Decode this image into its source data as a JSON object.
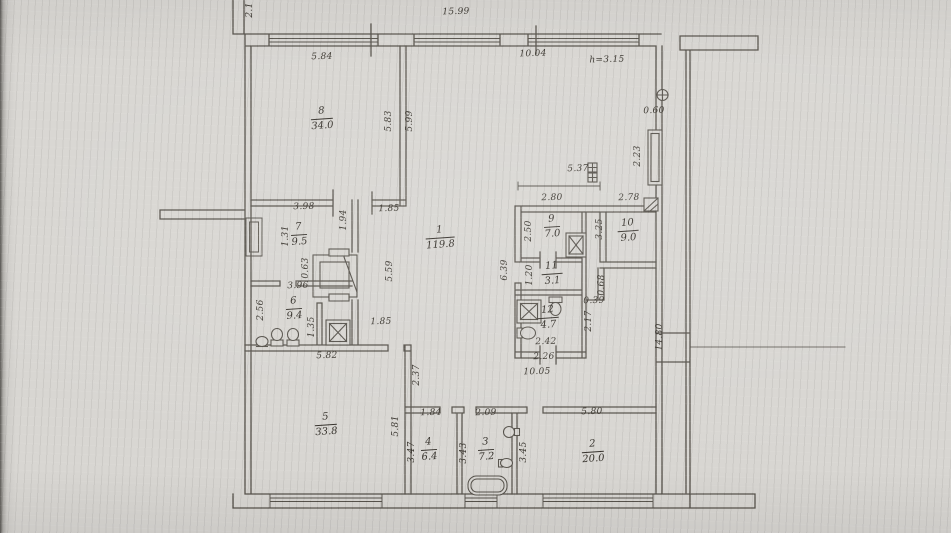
{
  "meta": {
    "type": "scanned-floor-plan",
    "paper_color": "#d8d6d2",
    "ink_color": "#55514a",
    "text_color": "#39352e"
  },
  "icons": {
    "shaft-square-x": "square with X diagonals (duct/lift shaft)",
    "vent-square-diagonal": "square with diagonal hatch (flue)",
    "meter-boxes": "two small gridded squares (meters)",
    "wall-socket-circle": "circle with bar on wall",
    "toilet": "bowl ellipse with tank rectangle",
    "sink": "oval basin",
    "bathtub": "rounded rectangle tub",
    "shower-tray": "double square with X",
    "entrance-vestibule": "nested rectangles with diagonal"
  },
  "plan": {
    "ceiling_note": "h=3.15",
    "rooms": [
      {
        "n": "8",
        "a": "34.0",
        "x": 322,
        "y": 119
      },
      {
        "n": "1",
        "a": "119.8",
        "x": 440,
        "y": 238
      },
      {
        "n": "7",
        "a": "9.5",
        "x": 299,
        "y": 235
      },
      {
        "n": "6",
        "a": "9.4",
        "x": 294,
        "y": 309
      },
      {
        "n": "9",
        "a": "7.0",
        "x": 552,
        "y": 227
      },
      {
        "n": "10",
        "a": "9.0",
        "x": 628,
        "y": 231
      },
      {
        "n": "11",
        "a": "3.1",
        "x": 552,
        "y": 274
      },
      {
        "n": "12",
        "a": "4.7",
        "x": 548,
        "y": 318
      },
      {
        "n": "5",
        "a": "33.8",
        "x": 326,
        "y": 425
      },
      {
        "n": "4",
        "a": "6.4",
        "x": 429,
        "y": 450
      },
      {
        "n": "3",
        "a": "7.2",
        "x": 486,
        "y": 450
      },
      {
        "n": "2",
        "a": "20.0",
        "x": 593,
        "y": 452
      }
    ],
    "dims": [
      {
        "t": "15.99",
        "x": 456,
        "y": 12,
        "rot": 0
      },
      {
        "t": "2.1",
        "x": 250,
        "y": 10,
        "rot": 1
      },
      {
        "t": "5.84",
        "x": 322,
        "y": 57,
        "rot": 0
      },
      {
        "t": "10.04",
        "x": 533,
        "y": 54,
        "rot": 0
      },
      {
        "t": "h=3.15",
        "x": 607,
        "y": 60,
        "rot": 0
      },
      {
        "t": "0.60",
        "x": 654,
        "y": 111,
        "rot": 0
      },
      {
        "t": "5.83",
        "x": 389,
        "y": 121,
        "rot": 1
      },
      {
        "t": "5.99",
        "x": 410,
        "y": 121,
        "rot": 1
      },
      {
        "t": "2.23",
        "x": 638,
        "y": 156,
        "rot": 1
      },
      {
        "t": "5.37",
        "x": 578,
        "y": 169,
        "rot": 0
      },
      {
        "t": "2.80",
        "x": 552,
        "y": 198,
        "rot": 0
      },
      {
        "t": "2.78",
        "x": 629,
        "y": 198,
        "rot": 0
      },
      {
        "t": "3.98",
        "x": 304,
        "y": 207,
        "rot": 0
      },
      {
        "t": "1.85",
        "x": 389,
        "y": 209,
        "rot": 0
      },
      {
        "t": "1.94",
        "x": 344,
        "y": 220,
        "rot": 1
      },
      {
        "t": "1.31",
        "x": 286,
        "y": 236,
        "rot": 1
      },
      {
        "t": "2.50",
        "x": 529,
        "y": 231,
        "rot": 1
      },
      {
        "t": "3.25",
        "x": 600,
        "y": 229,
        "rot": 1
      },
      {
        "t": "0.63",
        "x": 306,
        "y": 268,
        "rot": 1
      },
      {
        "t": "5.59",
        "x": 390,
        "y": 271,
        "rot": 1
      },
      {
        "t": "6.39",
        "x": 505,
        "y": 270,
        "rot": 1
      },
      {
        "t": "1.20",
        "x": 530,
        "y": 275,
        "rot": 1
      },
      {
        "t": "0.68",
        "x": 602,
        "y": 285,
        "rot": 1
      },
      {
        "t": "3.96",
        "x": 298,
        "y": 286,
        "rot": 0
      },
      {
        "t": "0.39",
        "x": 594,
        "y": 301,
        "rot": 0
      },
      {
        "t": "2.56",
        "x": 261,
        "y": 310,
        "rot": 1
      },
      {
        "t": "1.35",
        "x": 312,
        "y": 327,
        "rot": 1
      },
      {
        "t": "2.17",
        "x": 589,
        "y": 321,
        "rot": 1
      },
      {
        "t": "1.85",
        "x": 381,
        "y": 322,
        "rot": 0
      },
      {
        "t": "14.80",
        "x": 660,
        "y": 337,
        "rot": 1
      },
      {
        "t": "2.42",
        "x": 546,
        "y": 342,
        "rot": 0
      },
      {
        "t": "5.82",
        "x": 327,
        "y": 356,
        "rot": 0
      },
      {
        "t": "2.26",
        "x": 544,
        "y": 357,
        "rot": 0
      },
      {
        "t": "10.05",
        "x": 537,
        "y": 372,
        "rot": 0
      },
      {
        "t": "2.37",
        "x": 417,
        "y": 375,
        "rot": 1
      },
      {
        "t": "1.84",
        "x": 431,
        "y": 413,
        "rot": 0
      },
      {
        "t": "2.09",
        "x": 486,
        "y": 413,
        "rot": 0
      },
      {
        "t": "5.80",
        "x": 592,
        "y": 412,
        "rot": 0
      },
      {
        "t": "5.81",
        "x": 396,
        "y": 426,
        "rot": 1
      },
      {
        "t": "3.47",
        "x": 412,
        "y": 452,
        "rot": 1
      },
      {
        "t": "3.43",
        "x": 464,
        "y": 453,
        "rot": 1
      },
      {
        "t": "3.45",
        "x": 524,
        "y": 452,
        "rot": 1
      }
    ]
  }
}
